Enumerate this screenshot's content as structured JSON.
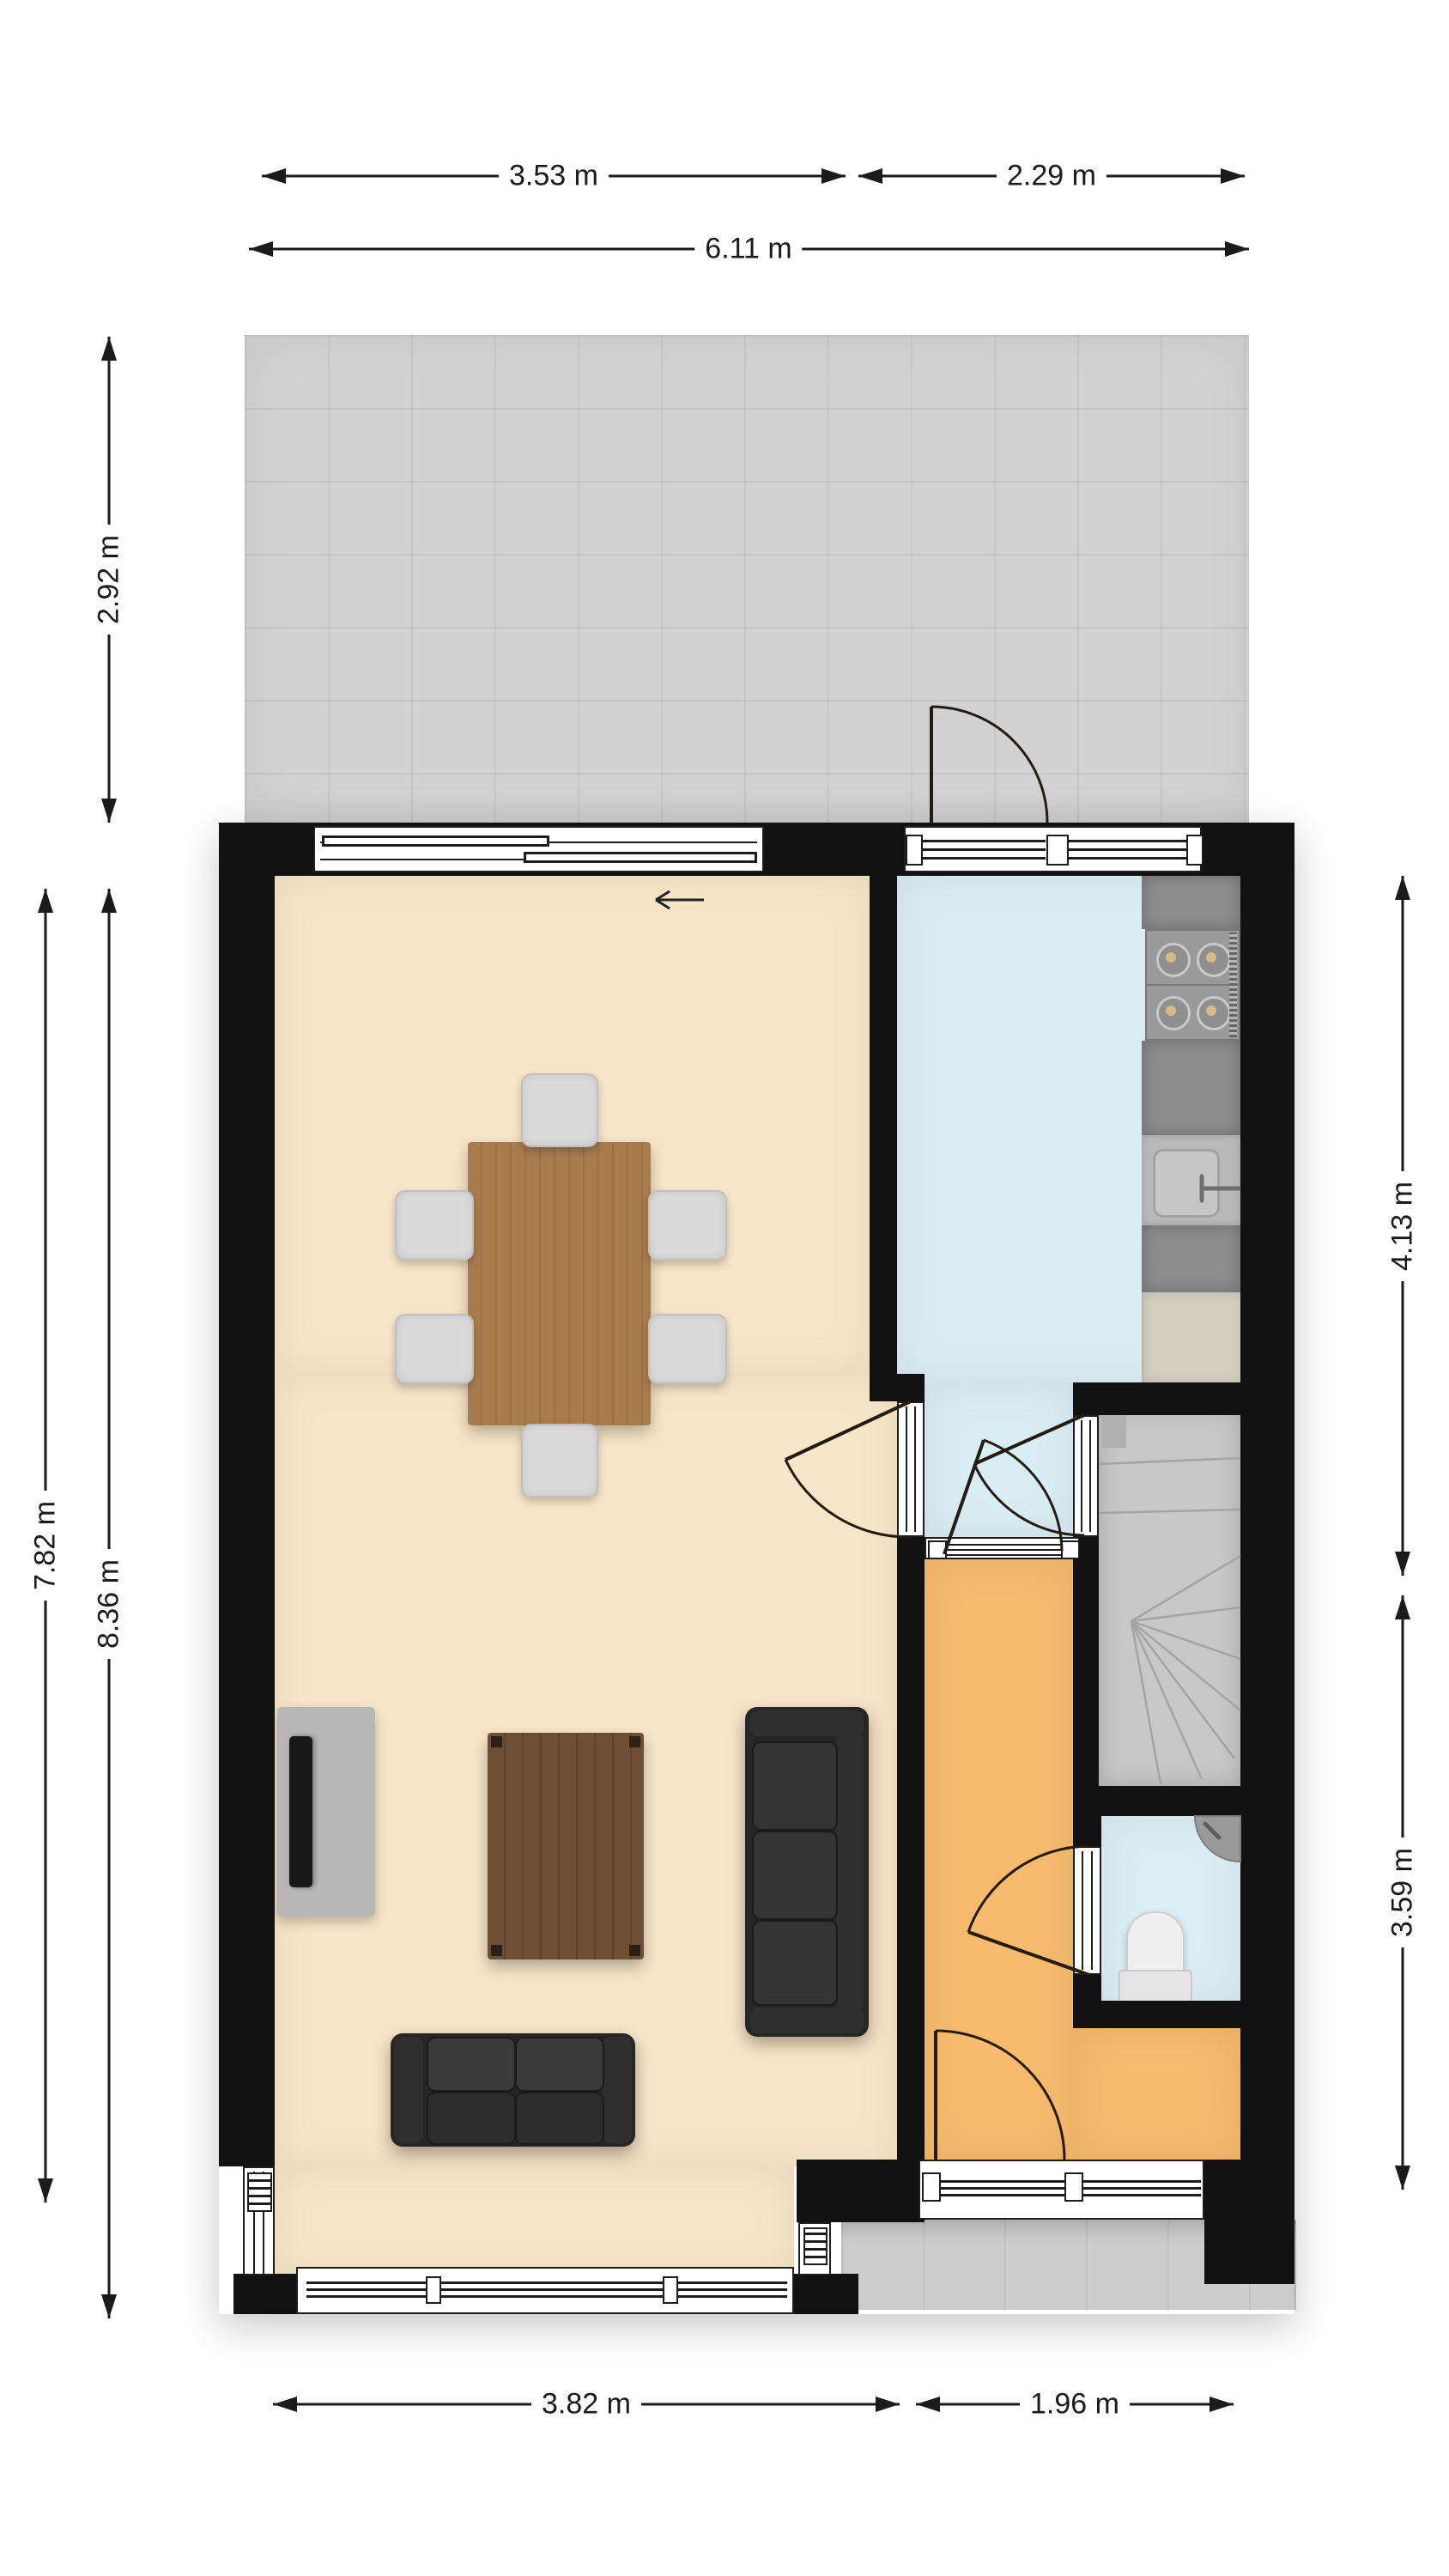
{
  "plan": {
    "type": "floor-plan",
    "floor_texts": [],
    "rooms": [
      "terrace",
      "living-room",
      "kitchen",
      "staircase",
      "toilet",
      "hallway"
    ],
    "furniture": [
      "dining-table",
      "dining-chairs",
      "tv",
      "tv-console",
      "coffee-table",
      "three-seat-sofa",
      "two-seat-sofa",
      "stove",
      "kitchen-sink",
      "kitchen-cabinet",
      "toilet-bowl",
      "corner-washbasin",
      "winder-stairs"
    ]
  },
  "dims": {
    "top_partial_left": {
      "label": "3.53 m"
    },
    "top_partial_right": {
      "label": "2.29 m"
    },
    "top_total": {
      "label": "6.11 m"
    },
    "terrace_depth": {
      "label": "2.92 m"
    },
    "house_inner_depth": {
      "label": "7.82 m"
    },
    "house_outer_depth": {
      "label": "8.36 m"
    },
    "kitchen_depth": {
      "label": "4.13 m"
    },
    "hall_depth": {
      "label": "3.59 m"
    },
    "bottom_living_width": {
      "label": "3.82 m"
    },
    "bottom_hall_width": {
      "label": "1.96 m"
    }
  },
  "colors": {
    "wall": "#111111",
    "living_floor": "#f8e6c8",
    "kitchen_floor": "#d9edf4",
    "toilet_floor": "#dceef5",
    "hall_floor": "#f6bb6d",
    "terrace": "#d2d2d2",
    "path": "#cdcdcd",
    "stairs": "#c8c8c8",
    "table_wood": "#a97c4e",
    "coffee_wood": "#6f4e36",
    "sofa": "#262626",
    "chair": "#dadada",
    "counter": "#8d8d8d",
    "cabinet": "#d4cec1",
    "dimension_text": "#1b1b1b"
  }
}
